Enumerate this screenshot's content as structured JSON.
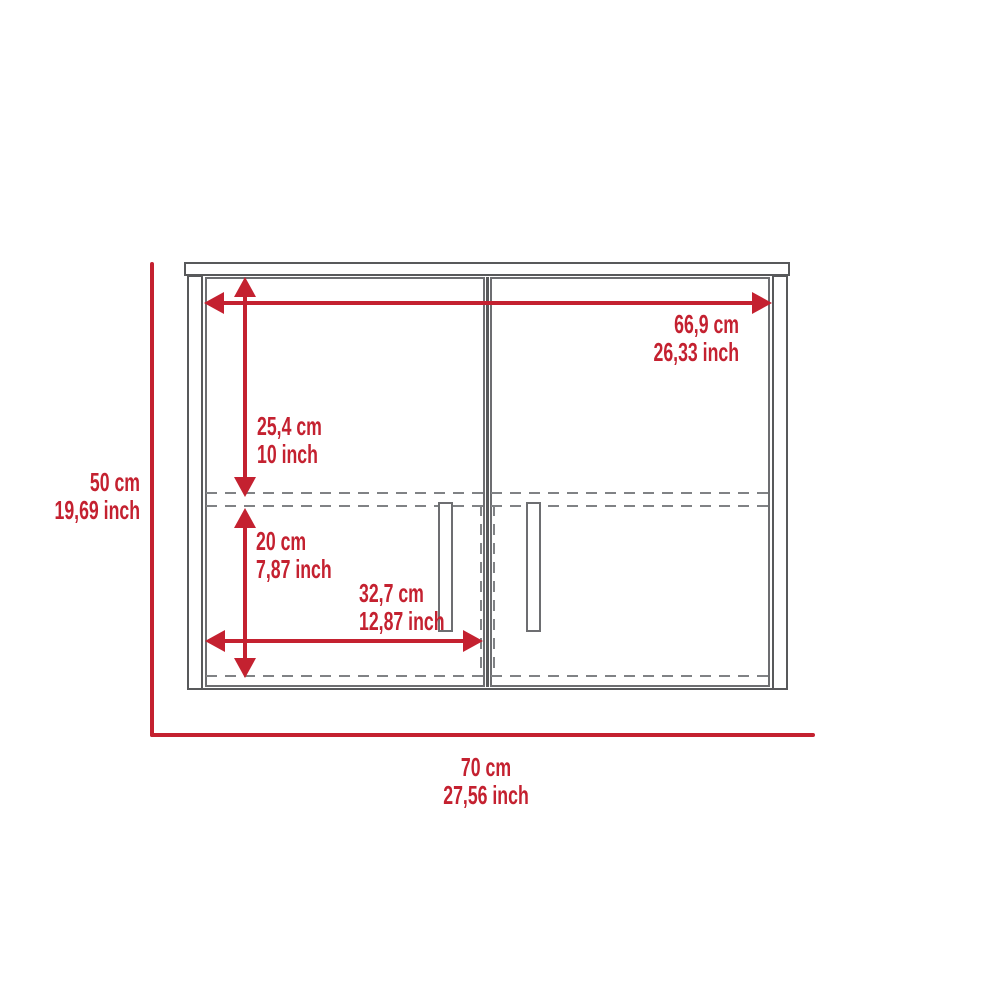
{
  "diagram": {
    "kind": "furniture-dimension-drawing",
    "subject": "two-door wall cabinet, front view",
    "units": [
      "cm",
      "inch"
    ],
    "colors": {
      "accent_red": "#c42130",
      "outline_gray": "#58595b",
      "dash_gray": "#808285",
      "background": "#ffffff"
    }
  },
  "labels": {
    "overall_height": {
      "cm": "50 cm",
      "inch": "19,69 inch"
    },
    "overall_width": {
      "cm": "70 cm",
      "inch": "27,56 inch"
    },
    "inner_width": {
      "cm": "66,9 cm",
      "inch": "26,33 inch"
    },
    "upper_section": {
      "cm": "25,4 cm",
      "inch": "10 inch"
    },
    "lower_section": {
      "cm": "20 cm",
      "inch": "7,87 inch"
    },
    "door_width": {
      "cm": "32,7 cm",
      "inch": "12,87 inch"
    }
  }
}
